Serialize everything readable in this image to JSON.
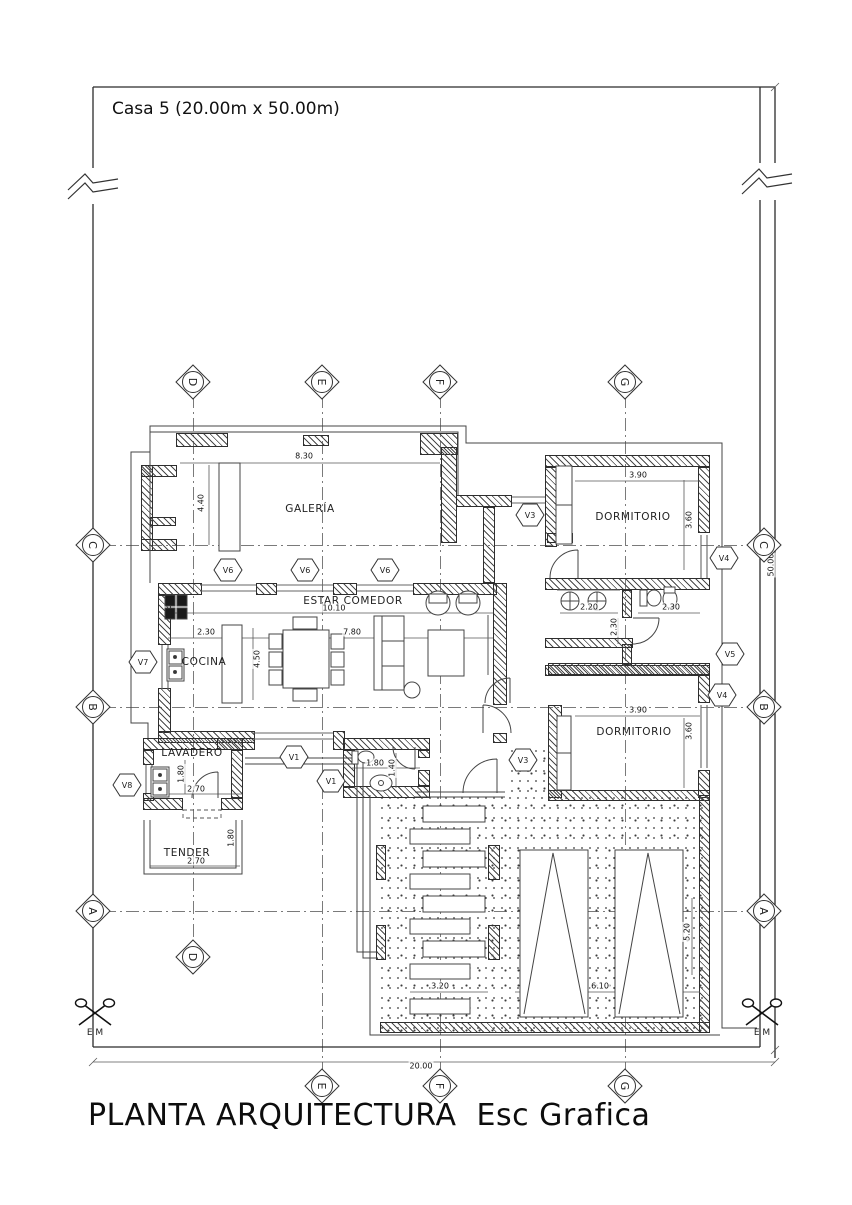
{
  "title": {
    "project": "Casa 5 (20.00m x 50.00m)",
    "plan": "PLANTA ARQUITECTURA  Esc Grafica"
  },
  "boundary": {
    "survey_marker": "E M"
  },
  "rooms": [
    {
      "name": "GALERÍA",
      "x": 310,
      "y": 509
    },
    {
      "name": "ESTAR COMEDOR",
      "x": 353,
      "y": 601
    },
    {
      "name": "COCINA",
      "x": 204,
      "y": 662
    },
    {
      "name": "LAVADERO",
      "x": 192,
      "y": 753
    },
    {
      "name": "TENDER",
      "x": 187,
      "y": 853
    },
    {
      "name": "DORMITORIO",
      "x": 633,
      "y": 517
    },
    {
      "name": "DORMITORIO",
      "x": 634,
      "y": 732
    }
  ],
  "window_tags": [
    {
      "label": "V6",
      "x": 228,
      "y": 570
    },
    {
      "label": "V6",
      "x": 305,
      "y": 570
    },
    {
      "label": "V6",
      "x": 385,
      "y": 570
    },
    {
      "label": "V3",
      "x": 530,
      "y": 515
    },
    {
      "label": "V4",
      "x": 724,
      "y": 558
    },
    {
      "label": "V5",
      "x": 730,
      "y": 654
    },
    {
      "label": "V4",
      "x": 722,
      "y": 695
    },
    {
      "label": "V3",
      "x": 523,
      "y": 760
    },
    {
      "label": "V7",
      "x": 143,
      "y": 662
    },
    {
      "label": "V8",
      "x": 127,
      "y": 785
    },
    {
      "label": "V1",
      "x": 294,
      "y": 757
    },
    {
      "label": "V1",
      "x": 331,
      "y": 781
    }
  ],
  "grid_markers": [
    {
      "label": "D",
      "x": 193,
      "y": 382
    },
    {
      "label": "E",
      "x": 322,
      "y": 382
    },
    {
      "label": "F",
      "x": 440,
      "y": 382
    },
    {
      "label": "G",
      "x": 625,
      "y": 382
    },
    {
      "label": "C",
      "x": 93,
      "y": 545
    },
    {
      "label": "B",
      "x": 93,
      "y": 707
    },
    {
      "label": "A",
      "x": 93,
      "y": 911
    },
    {
      "label": "C",
      "x": 764,
      "y": 545
    },
    {
      "label": "B",
      "x": 764,
      "y": 707
    },
    {
      "label": "A",
      "x": 764,
      "y": 911
    },
    {
      "label": "D",
      "x": 193,
      "y": 957
    },
    {
      "label": "E",
      "x": 322,
      "y": 1086
    },
    {
      "label": "F",
      "x": 440,
      "y": 1086
    },
    {
      "label": "G",
      "x": 625,
      "y": 1086
    }
  ],
  "dimensions": [
    {
      "text": "8.30",
      "x": 304,
      "y": 456,
      "rot": 0
    },
    {
      "text": "4.40",
      "x": 201,
      "y": 503,
      "rot": -90
    },
    {
      "text": "10.10",
      "x": 334,
      "y": 608,
      "rot": 0
    },
    {
      "text": "7.80",
      "x": 352,
      "y": 632,
      "rot": 0
    },
    {
      "text": "2.30",
      "x": 206,
      "y": 632,
      "rot": 0
    },
    {
      "text": "4.50",
      "x": 257,
      "y": 659,
      "rot": -90
    },
    {
      "text": "2.20",
      "x": 589,
      "y": 607,
      "rot": 0
    },
    {
      "text": "2.30",
      "x": 614,
      "y": 627,
      "rot": -90
    },
    {
      "text": "2.30",
      "x": 671,
      "y": 607,
      "rot": 0
    },
    {
      "text": "3.90",
      "x": 638,
      "y": 475,
      "rot": 0
    },
    {
      "text": "3.60",
      "x": 689,
      "y": 520,
      "rot": -90
    },
    {
      "text": "3.90",
      "x": 638,
      "y": 710,
      "rot": 0
    },
    {
      "text": "3.60",
      "x": 689,
      "y": 731,
      "rot": -90
    },
    {
      "text": "1.80",
      "x": 181,
      "y": 774,
      "rot": -90
    },
    {
      "text": "2.70",
      "x": 196,
      "y": 789,
      "rot": 0
    },
    {
      "text": "1.80",
      "x": 231,
      "y": 838,
      "rot": -90
    },
    {
      "text": "2.70",
      "x": 196,
      "y": 861,
      "rot": 0
    },
    {
      "text": "1.80",
      "x": 375,
      "y": 763,
      "rot": 0
    },
    {
      "text": "1.40",
      "x": 392,
      "y": 768,
      "rot": -90
    },
    {
      "text": "3.20",
      "x": 440,
      "y": 986,
      "rot": 0
    },
    {
      "text": "6.10",
      "x": 600,
      "y": 986,
      "rot": 0
    },
    {
      "text": "5.20",
      "x": 687,
      "y": 932,
      "rot": -90
    },
    {
      "text": "20.00",
      "x": 421,
      "y": 1066,
      "rot": 0
    },
    {
      "text": "50.00",
      "x": 771,
      "y": 565,
      "rot": -90
    }
  ]
}
